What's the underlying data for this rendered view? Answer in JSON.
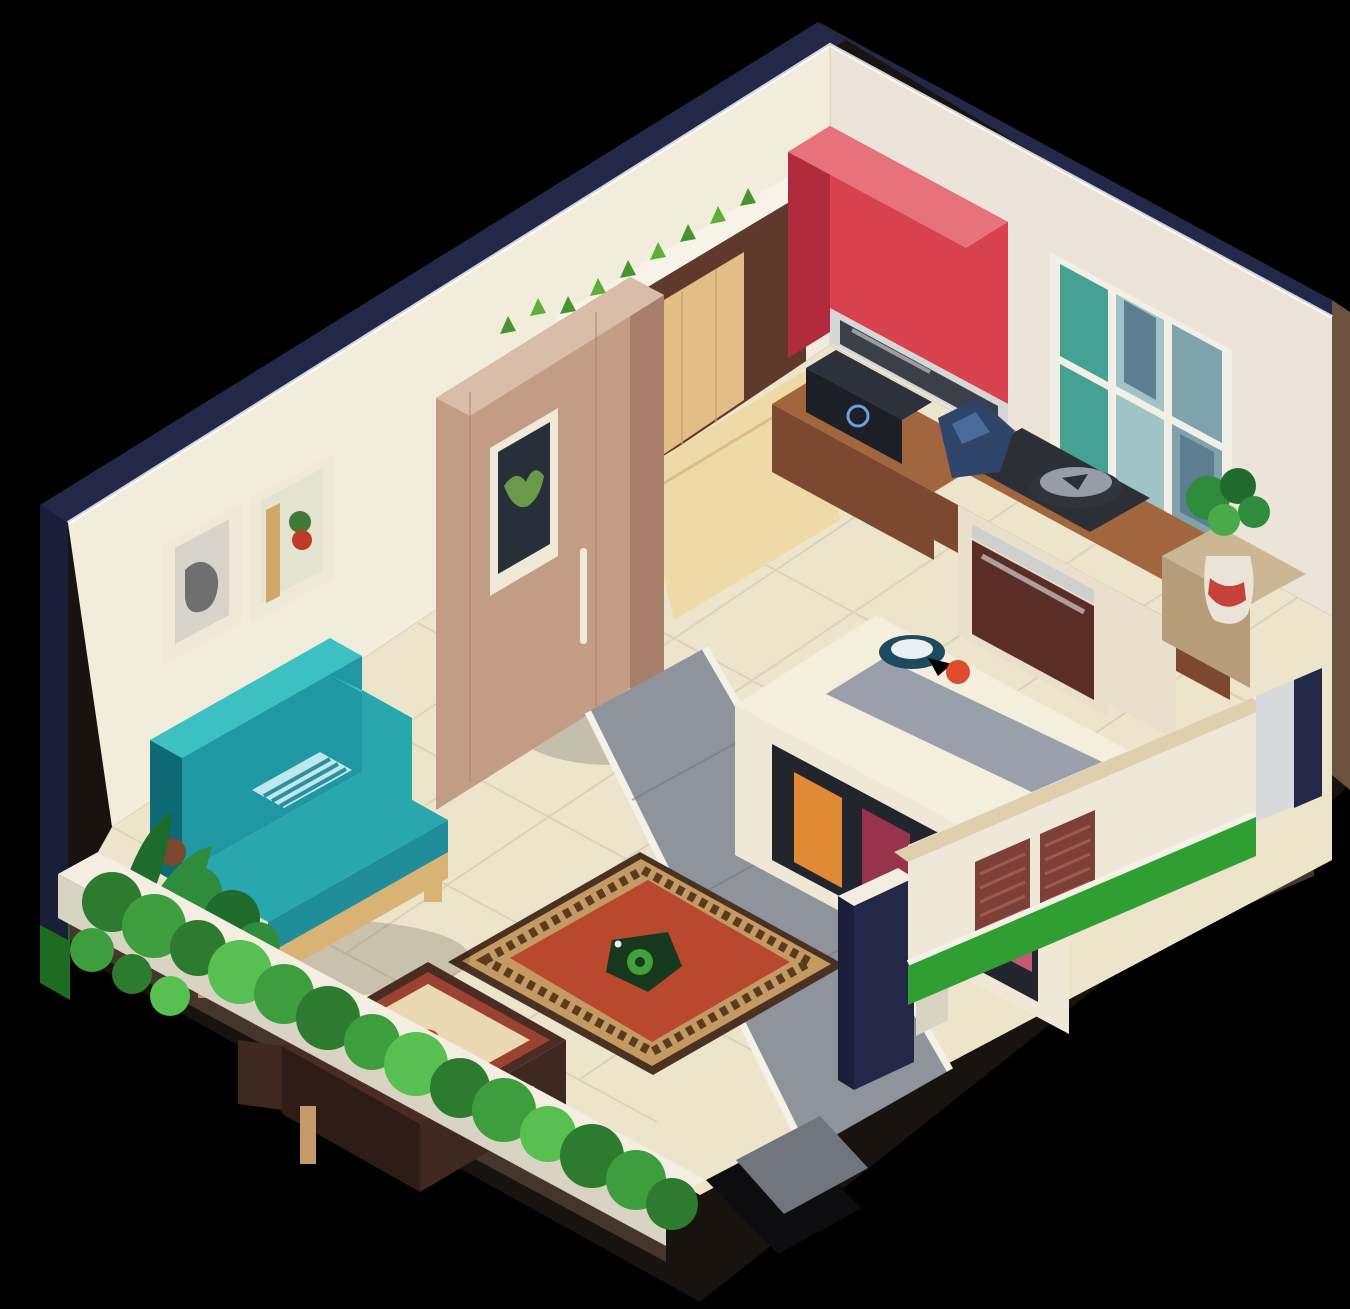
{
  "meta": {
    "description": "Isometric cutaway illustration of a small studio apartment with living room, open kitchen and front garden, on a black background",
    "background": "#000000"
  },
  "scene": {
    "rooms": [
      "living-room",
      "kitchen",
      "front-garden"
    ],
    "objects": [
      "back-left-wall",
      "back-right-wall",
      "framed-portrait",
      "framed-still-life",
      "six-pane-window",
      "red-upper-cabinet",
      "range-hood",
      "microwave",
      "wood-counter",
      "stove-oven",
      "cooking-pot",
      "blue-bag",
      "potted-plant",
      "entry-door",
      "open-door-panel",
      "vine-sprigs",
      "wardrobe",
      "teal-sofa",
      "striped-pillow",
      "planter-plants",
      "terracotta-rug",
      "coffee-table",
      "kitchen-island",
      "island-stools",
      "fruit-bowl",
      "garden-hedge",
      "garden-wall",
      "gate-post",
      "shutter-wall",
      "louvered-shutters",
      "grass-strip",
      "tiled-floor",
      "gray-walkway"
    ]
  },
  "palette": {
    "bg": "#000000",
    "edgeNavy": "#232848",
    "edgeNavyDark": "#1a1e38",
    "outerBrown": "#6b5140",
    "platformBrown": "#46352a",
    "platformDark": "#191310",
    "grassBright": "#2f9e33",
    "grassDark": "#1e6b22",
    "wallCream": "#f2ecdc",
    "wallCreamLight": "#faf7ee",
    "wallRight": "#ece4d8",
    "rimLight": "#ffffff",
    "floorTile": "#ece4cb",
    "floorSeam": "#d9d2b8",
    "walkGray": "#8f939c",
    "walkGrayDark": "#70757e",
    "curbWhite": "#f4f1e6",
    "shadowSoft": "#8a857c",
    "exitDark": "#0d0d0f",
    "windowFrame": "#f2efe6",
    "glassTeal": "#45a193",
    "glassBlue": "#9fc3c6",
    "glassGray": "#7fa3ad",
    "glassDark": "#5d7e8e",
    "redCabFront": "#d8424e",
    "redCabSide": "#b02c3c",
    "redCabTop": "#e8727c",
    "chrome": "#d6d6d6",
    "hoodGlass": "#3a4048",
    "applianceBlack": "#1c1f26",
    "applianceBlackTop": "#2c313c",
    "ringBlue": "#6a9fe0",
    "counterWoodTop": "#a2663f",
    "counterWoodFront": "#7c4930",
    "cabinetCream": "#e9dfcc",
    "ovenDoor": "#5a2e26",
    "steel": "#cfcfcf",
    "cooktop": "#2c3036",
    "potBody": "#31353b",
    "potLid": "#979da6",
    "bagNavy": "#2e4468",
    "bagNavyLight": "#4a6a9a",
    "counterTan": "#cbb794",
    "counterTanFront": "#b79c7a",
    "plantGreen": "#2f8c3c",
    "plantGreenLight": "#4aaa4a",
    "plantGreenDark": "#1f6b2e",
    "vaseWhite": "#eae4d8",
    "vaseRed": "#c5413a",
    "doorFrameBrown": "#5f3a2c",
    "doorWood": "#e2bd85",
    "doorWoodGrain": "#c9a36a",
    "doorOpenWood": "#eedaa6",
    "lintelWhite": "#f7f3e8",
    "sprigGreen": "#5fae3a",
    "sprigGreenDark": "#47942e",
    "wardrobeFront": "#c29c84",
    "wardrobeSide": "#a87f6a",
    "wardrobeTop": "#d9bda8",
    "artDark": "#273038",
    "artLeaf": "#6a9a4a",
    "frameCream": "#f1e9d7",
    "artGrayBg": "#d8d4cc",
    "artGray": "#6f6f6f",
    "artStillBg": "#e3e3cf",
    "artRed": "#c03a2a",
    "artGreen": "#3f7a38",
    "artTan": "#cfa96a",
    "sofaLight": "#3cc0c2",
    "sofaMid": "#28a8ae",
    "sofaMidDark": "#1f98a4",
    "sofaDark": "#0e6a74",
    "sofaFront": "#1f8e9a",
    "pillowLight": "#bfe8ec",
    "pillowStripe": "#2e8ea0",
    "sofaWood": "#d9b276",
    "sofaWoodDark": "#c0935a",
    "rugEdge": "#4a3222",
    "rugBorder": "#c49a62",
    "rugBorderDark": "#5a3a22",
    "rugField": "#b8492c",
    "rugCenterDark": "#16381f",
    "rugSwirl": "#3fa03c",
    "tableDark": "#4a2c24",
    "tableDarker": "#2e1c16",
    "tableSide": "#3f2820",
    "tableLip": "#9c4230",
    "tableTop": "#ead8b2",
    "tableRed": "#d42f2e",
    "tableLeg": "#c49a6a",
    "hedge1": "#2c7b2e",
    "hedge2": "#3e9e3d",
    "hedge3": "#57c050",
    "gardenWallTop": "#f3eee1",
    "gardenWallFace": "#d9d3c3",
    "islandCream": "#f0e8d6",
    "islandCreamLight": "#f4eedd",
    "islandEnd": "#e7ddc8",
    "islandGray": "#99a0ab",
    "islandOpening": "#22252b",
    "cushionOrange": "#e08a36",
    "cushionMaroon": "#97334a",
    "cushionMaroonDark": "#7c2a3c",
    "cushionPink": "#c25a74",
    "bowlTeal": "#1e4a5e",
    "bowlWhite": "#e9eff3",
    "fruitRed": "#df4a31",
    "coping": "#dfcfae",
    "shutterWall": "#efe8d8",
    "shutter": "#7c4038",
    "shutterSlat": "#a05a4c",
    "cornerLight": "#d7d9dc"
  }
}
